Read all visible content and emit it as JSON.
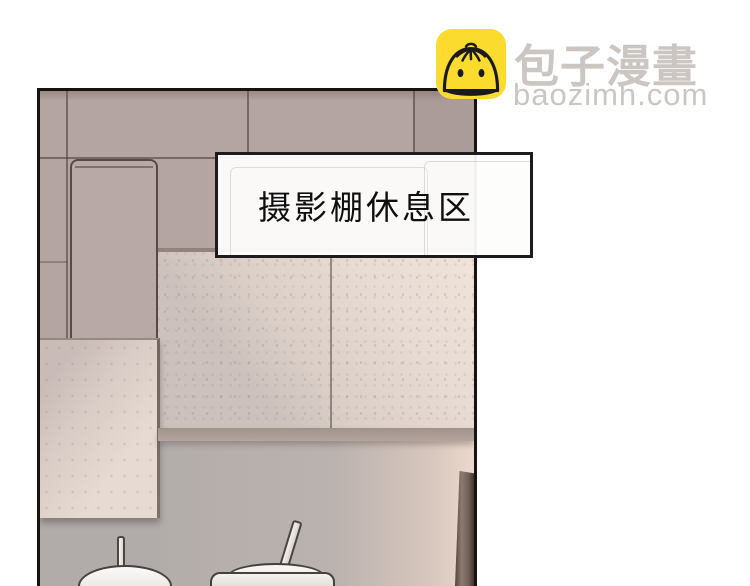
{
  "page": {
    "background_color": "#ffffff"
  },
  "watermark": {
    "site_name": "包子漫畫",
    "site_url": "baozimh.com",
    "icon": "baozi-bun-icon",
    "icon_bg_color": "#fbdb2e",
    "text_color": "#cbc6c2"
  },
  "comic_panel": {
    "caption": "摄影棚休息区",
    "caption_text_color": "#0f0f0f",
    "caption_bg": "rgba(255,255,255,0.93)",
    "panel_border_color": "#17130f",
    "wall_mauve_color": "#b4a5a2",
    "tile_light_color": "#e7dbd3",
    "lower_wall_gray": "#b7b1ae",
    "door_frame_brown": "#6f5f56",
    "objects": [
      "wall-tiles",
      "storage-cabinet",
      "wall-light-panel",
      "rice-cooker-left",
      "rice-cooker-right",
      "door-frame"
    ]
  }
}
